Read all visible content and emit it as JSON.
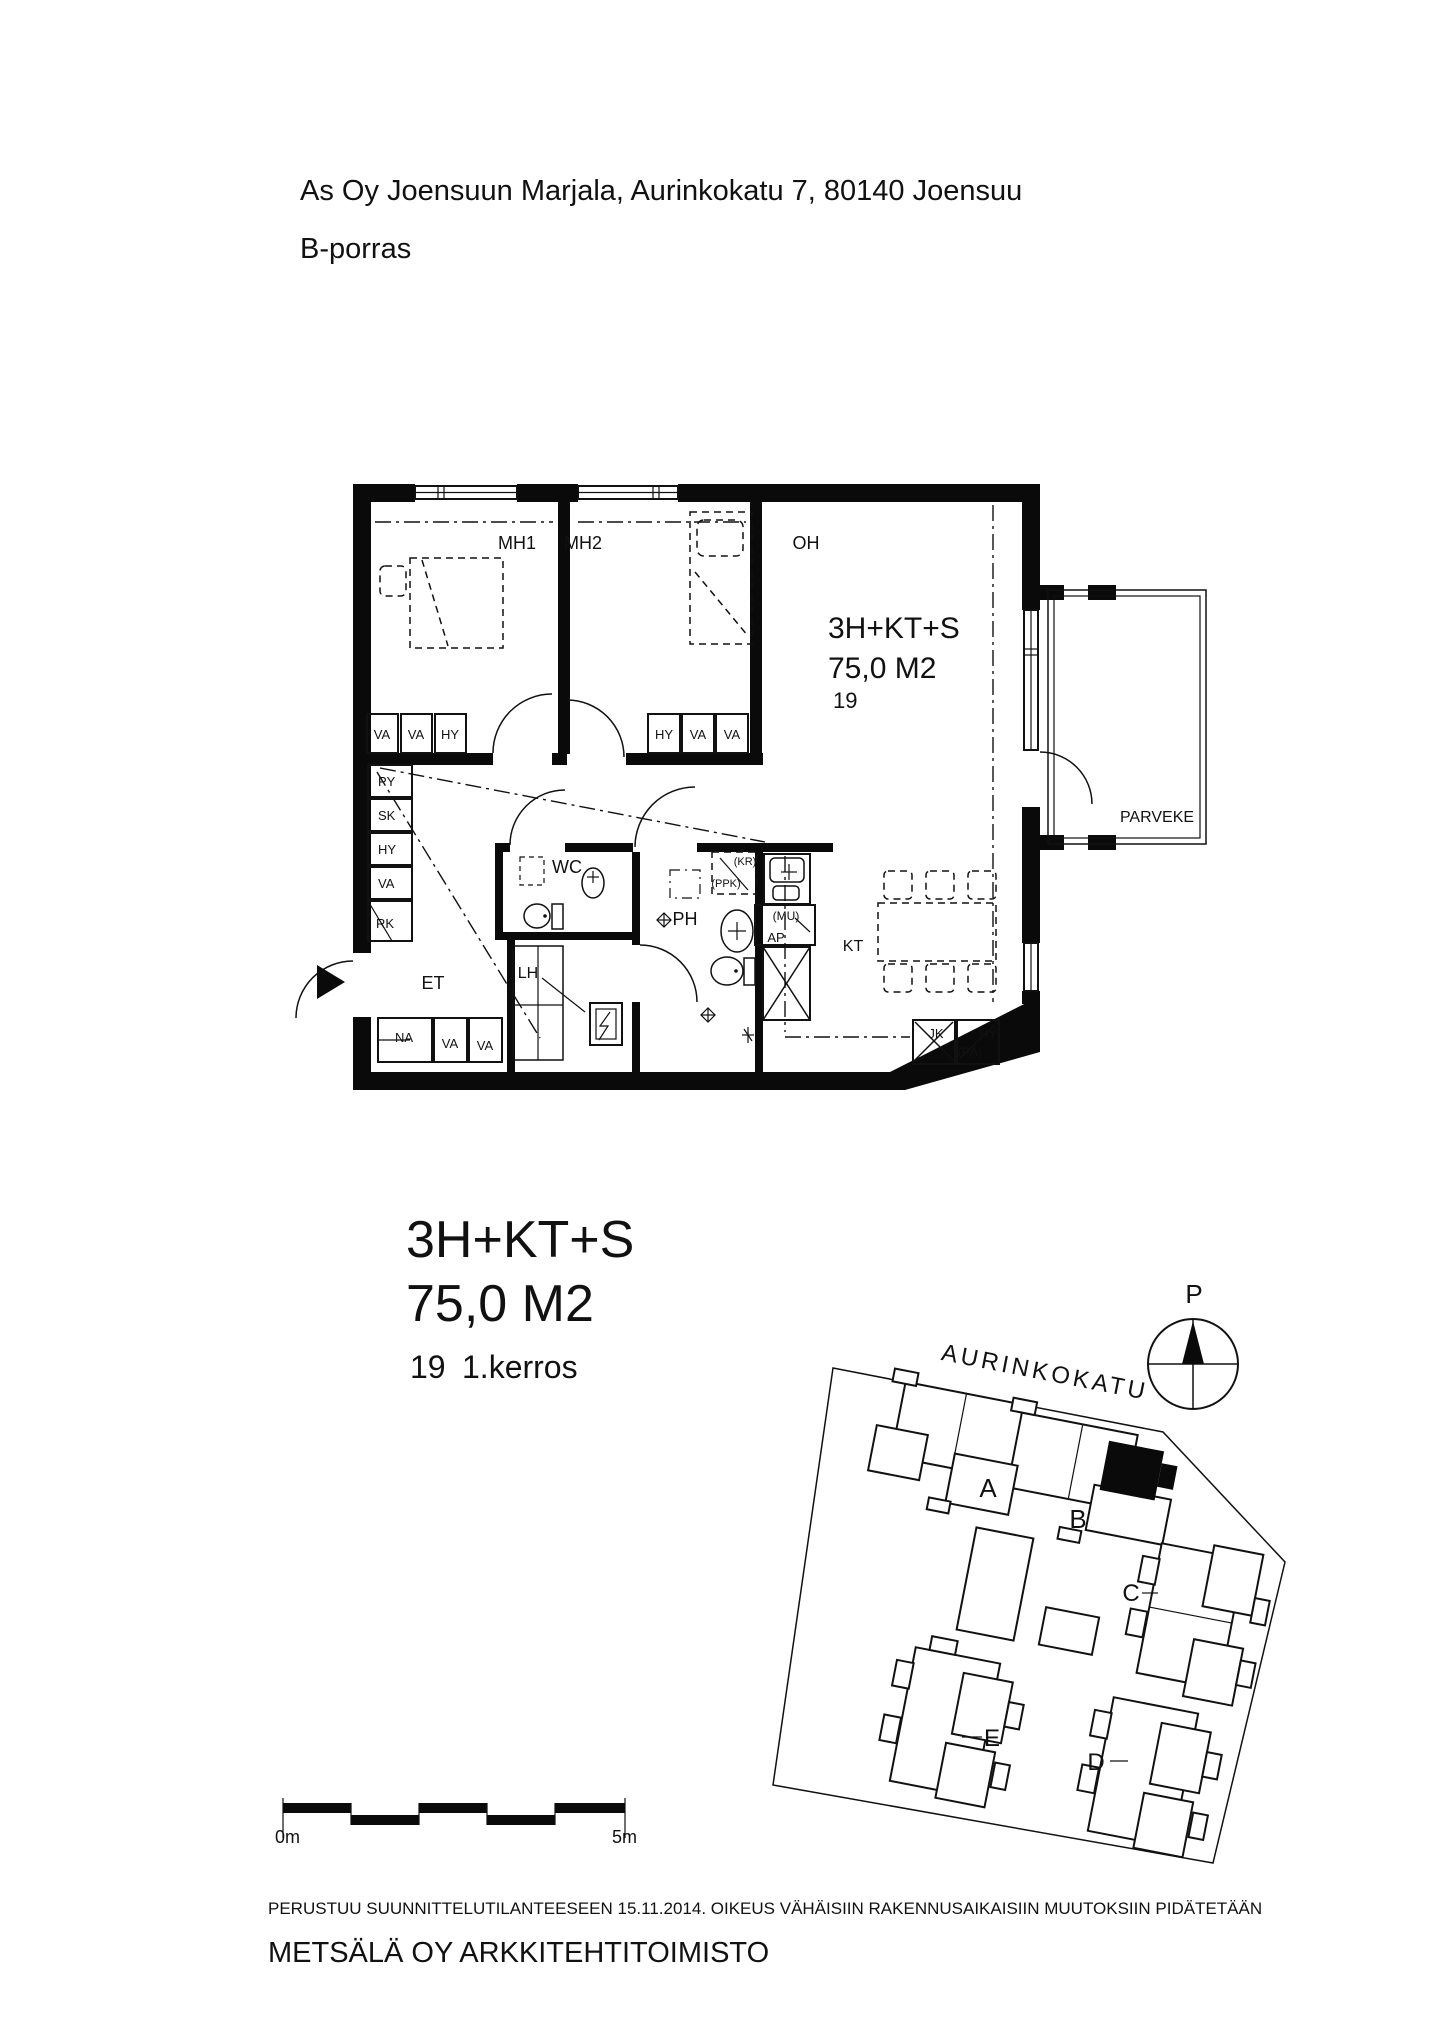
{
  "header": {
    "address": "As Oy Joensuun Marjala, Aurinkokatu 7, 80140 Joensuu",
    "staircase": "B-porras"
  },
  "plan": {
    "rooms": {
      "mh1": "MH1",
      "mh2": "MH2",
      "oh": "OH",
      "wc": "WC",
      "ph": "PH",
      "et": "ET",
      "lh": "LH",
      "kt": "KT",
      "parveke": "PARVEKE"
    },
    "info": {
      "type": "3H+KT+S",
      "area": "75,0 M2",
      "number": "19"
    },
    "closets": {
      "mh1_row": [
        "VA",
        "VA",
        "HY"
      ],
      "mh2_row": [
        "HY",
        "VA",
        "VA"
      ],
      "left_column": [
        "PY",
        "SK",
        "HY",
        "VA",
        "RK"
      ],
      "entry_row": [
        "NA",
        "VA",
        "VA"
      ]
    },
    "appliances": {
      "kr": "(KR)",
      "ppk": "(PPK)",
      "mu": "(MU)",
      "ap": "AP",
      "jk": "JK",
      "hy": "HY",
      "pa": "(PÄ)"
    }
  },
  "summary": {
    "type": "3H+KT+S",
    "area": "75,0 M2",
    "number": "19",
    "floor": "1.kerros"
  },
  "site": {
    "north": "P",
    "street": "AURINKOKATU",
    "buildings": [
      "A",
      "B",
      "C",
      "D",
      "E"
    ]
  },
  "scale": {
    "start": "0m",
    "end": "5m"
  },
  "footer": {
    "disclaimer": "PERUSTUU SUUNNITTELUTILANTEESEEN 15.11.2014. OIKEUS VÄHÄISIIN RAKENNUSAIKAISIIN MUUTOKSIIN PIDÄTETÄÄN",
    "firm": "METSÄLÄ OY ARKKITEHTITOIMISTO"
  }
}
